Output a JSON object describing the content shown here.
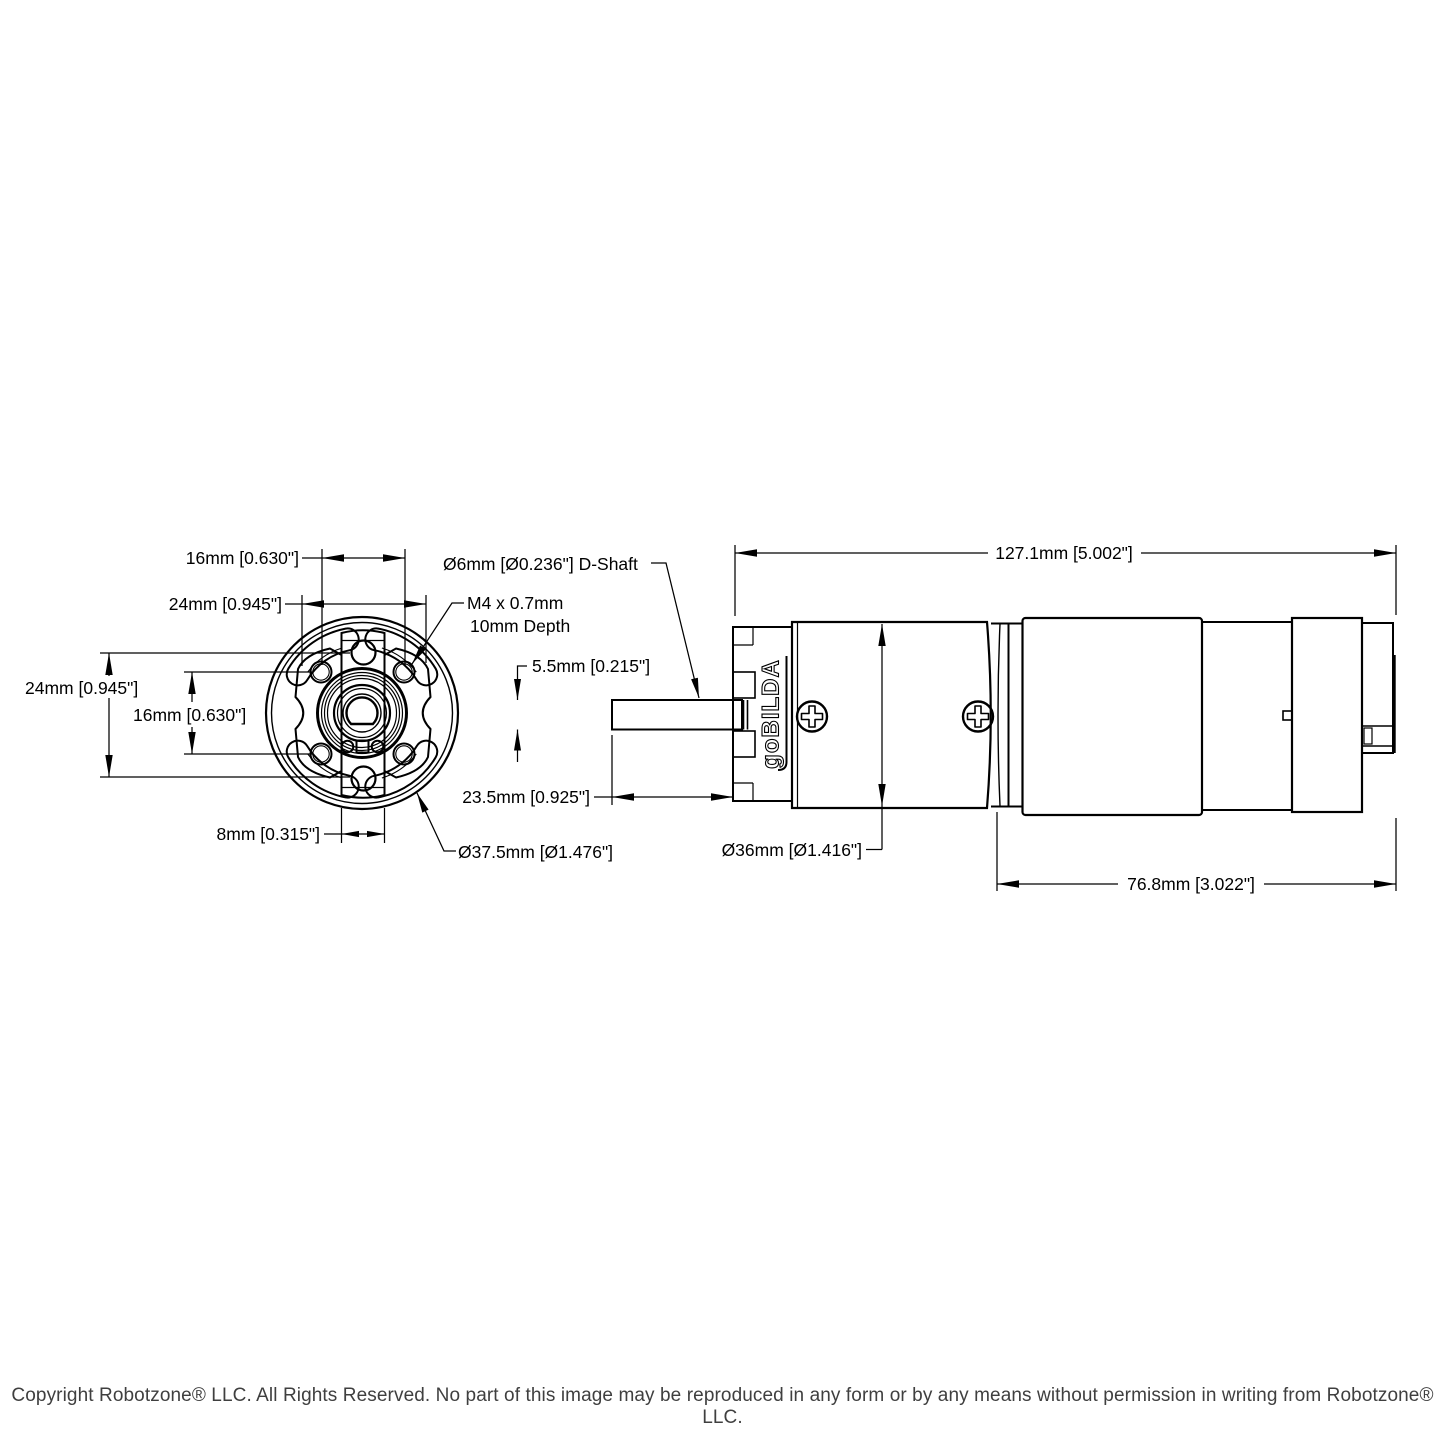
{
  "page": {
    "background": "#ffffff",
    "line_color": "#000000",
    "copyright_color": "#3f3f3f"
  },
  "front_view": {
    "dims": {
      "top_16mm": "16mm [0.630\"]",
      "top_24mm": "24mm [0.945\"]",
      "left_24mm": "24mm [0.945\"]",
      "left_16mm": "16mm [0.630\"]",
      "bottom_8mm": "8mm [0.315\"]",
      "face_diameter": "Ø37.5mm [Ø1.476\"]"
    }
  },
  "side_view": {
    "labels": {
      "d_shaft": "Ø6mm [Ø0.236\"] D-Shaft",
      "tap_line1": "M4 x 0.7mm",
      "tap_line2": "10mm Depth",
      "brand": "goBILDA"
    },
    "dims": {
      "shaft_diameter": "5.5mm [0.215\"]",
      "shaft_length": "23.5mm [0.925\"]",
      "body_diameter": "Ø36mm [Ø1.416\"]",
      "overall_length": "127.1mm [5.002\"]",
      "body_length": "76.8mm [3.022\"]"
    }
  },
  "footer": {
    "copyright": "Copyright Robotzone® LLC.  All Rights Reserved. No part of this image may be reproduced in any form or by any means without permission in writing from Robotzone® LLC."
  }
}
